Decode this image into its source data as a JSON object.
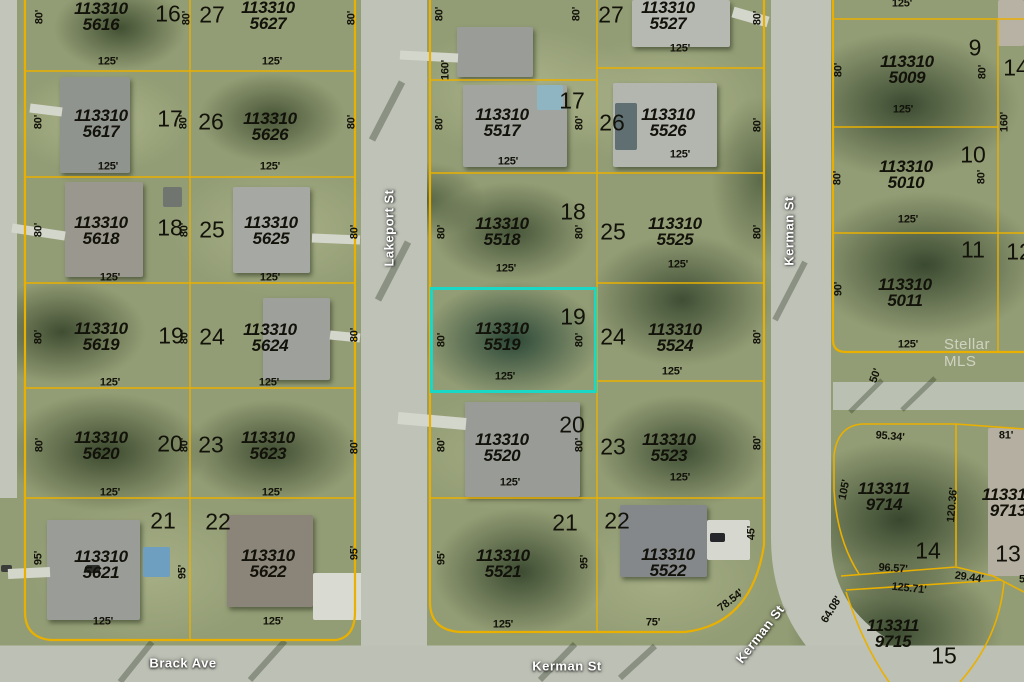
{
  "map": {
    "type": "aerial-parcel-map",
    "watermark": "Stellar MLS",
    "colors": {
      "parcel_line": "#EAB000",
      "highlight": "#1BD7C6",
      "road": "#BFC3B7"
    },
    "highlighted_parcel": {
      "apn": "113310 5519",
      "lot": "19"
    },
    "streets": [
      {
        "t": "Lakeport St",
        "x": 389,
        "y": 228,
        "r": -90
      },
      {
        "t": "Kerman St",
        "x": 789,
        "y": 231,
        "r": -90
      },
      {
        "t": "Brack Ave",
        "x": 183,
        "y": 663,
        "r": 0
      },
      {
        "t": "Kerman St",
        "x": 567,
        "y": 666,
        "r": 0
      },
      {
        "t": "Kerman St",
        "x": 760,
        "y": 634,
        "r": -52
      }
    ],
    "parcel_ids": [
      {
        "t": "113310\n5616",
        "x": 101,
        "y": 17
      },
      {
        "t": "113310\n5627",
        "x": 268,
        "y": 16
      },
      {
        "t": "113310\n5617",
        "x": 101,
        "y": 124
      },
      {
        "t": "113310\n5626",
        "x": 270,
        "y": 127
      },
      {
        "t": "113310\n5517",
        "x": 502,
        "y": 123
      },
      {
        "t": "113310\n5527",
        "x": 668,
        "y": 16
      },
      {
        "t": "113310\n5526",
        "x": 668,
        "y": 123
      },
      {
        "t": "113310\n5618",
        "x": 101,
        "y": 231
      },
      {
        "t": "113310\n5625",
        "x": 271,
        "y": 231
      },
      {
        "t": "113310\n5518",
        "x": 502,
        "y": 232
      },
      {
        "t": "113310\n5525",
        "x": 675,
        "y": 232
      },
      {
        "t": "113310\n5619",
        "x": 101,
        "y": 337
      },
      {
        "t": "113310\n5624",
        "x": 270,
        "y": 338
      },
      {
        "t": "113310\n5519",
        "x": 502,
        "y": 337
      },
      {
        "t": "113310\n5524",
        "x": 675,
        "y": 338
      },
      {
        "t": "113310\n5620",
        "x": 101,
        "y": 446
      },
      {
        "t": "113310\n5623",
        "x": 268,
        "y": 446
      },
      {
        "t": "113310\n5520",
        "x": 502,
        "y": 448
      },
      {
        "t": "113310\n5523",
        "x": 669,
        "y": 448
      },
      {
        "t": "113310\n5621",
        "x": 101,
        "y": 565
      },
      {
        "t": "113310\n5622",
        "x": 268,
        "y": 564
      },
      {
        "t": "113310\n5521",
        "x": 503,
        "y": 564
      },
      {
        "t": "113310\n5522",
        "x": 668,
        "y": 563
      },
      {
        "t": "113310\n5009",
        "x": 907,
        "y": 70
      },
      {
        "t": "113310\n5010",
        "x": 906,
        "y": 175
      },
      {
        "t": "113310\n5011",
        "x": 905,
        "y": 293
      },
      {
        "t": "113311\n9714",
        "x": 884,
        "y": 497
      },
      {
        "t": "113311\n9713",
        "x": 1008,
        "y": 503
      },
      {
        "t": "113311\n9715",
        "x": 893,
        "y": 634
      }
    ],
    "lot_numbers": [
      {
        "t": "16",
        "x": 168,
        "y": 14
      },
      {
        "t": "27",
        "x": 212,
        "y": 15
      },
      {
        "t": "17",
        "x": 170,
        "y": 119
      },
      {
        "t": "26",
        "x": 211,
        "y": 122
      },
      {
        "t": "18",
        "x": 170,
        "y": 228
      },
      {
        "t": "25",
        "x": 212,
        "y": 230
      },
      {
        "t": "19",
        "x": 171,
        "y": 336
      },
      {
        "t": "24",
        "x": 212,
        "y": 337
      },
      {
        "t": "20",
        "x": 170,
        "y": 444
      },
      {
        "t": "23",
        "x": 211,
        "y": 445
      },
      {
        "t": "21",
        "x": 163,
        "y": 521
      },
      {
        "t": "22",
        "x": 218,
        "y": 522
      },
      {
        "t": "27",
        "x": 611,
        "y": 15
      },
      {
        "t": "17",
        "x": 572,
        "y": 101
      },
      {
        "t": "26",
        "x": 612,
        "y": 123
      },
      {
        "t": "18",
        "x": 573,
        "y": 212
      },
      {
        "t": "25",
        "x": 613,
        "y": 232
      },
      {
        "t": "19",
        "x": 573,
        "y": 317
      },
      {
        "t": "24",
        "x": 613,
        "y": 337
      },
      {
        "t": "20",
        "x": 572,
        "y": 425
      },
      {
        "t": "23",
        "x": 613,
        "y": 447
      },
      {
        "t": "21",
        "x": 565,
        "y": 523
      },
      {
        "t": "22",
        "x": 617,
        "y": 521
      },
      {
        "t": "9",
        "x": 975,
        "y": 48
      },
      {
        "t": "14",
        "x": 1016,
        "y": 68
      },
      {
        "t": "10",
        "x": 973,
        "y": 155
      },
      {
        "t": "11",
        "x": 973,
        "y": 250
      },
      {
        "t": "12",
        "x": 1019,
        "y": 252
      },
      {
        "t": "14",
        "x": 928,
        "y": 551
      },
      {
        "t": "13",
        "x": 1008,
        "y": 554
      },
      {
        "t": "15",
        "x": 944,
        "y": 656
      }
    ],
    "dimensions": [
      {
        "t": "80'",
        "x": 40,
        "y": 17,
        "r": -90
      },
      {
        "t": "80'",
        "x": 187,
        "y": 18,
        "r": -90
      },
      {
        "t": "80'",
        "x": 352,
        "y": 18,
        "r": -90
      },
      {
        "t": "125'",
        "x": 108,
        "y": 62
      },
      {
        "t": "125'",
        "x": 272,
        "y": 62
      },
      {
        "t": "80'",
        "x": 39,
        "y": 122,
        "r": -90
      },
      {
        "t": "80'",
        "x": 184,
        "y": 122,
        "r": -90
      },
      {
        "t": "80'",
        "x": 352,
        "y": 122,
        "r": -90
      },
      {
        "t": "125'",
        "x": 108,
        "y": 167
      },
      {
        "t": "125'",
        "x": 270,
        "y": 167
      },
      {
        "t": "80'",
        "x": 39,
        "y": 230,
        "r": -90
      },
      {
        "t": "80'",
        "x": 185,
        "y": 230,
        "r": -90
      },
      {
        "t": "80'",
        "x": 355,
        "y": 232,
        "r": -90
      },
      {
        "t": "125'",
        "x": 110,
        "y": 278
      },
      {
        "t": "125'",
        "x": 270,
        "y": 278
      },
      {
        "t": "80'",
        "x": 39,
        "y": 337,
        "r": -90
      },
      {
        "t": "80'",
        "x": 185,
        "y": 337,
        "r": -90
      },
      {
        "t": "80'",
        "x": 355,
        "y": 335,
        "r": -90
      },
      {
        "t": "125'",
        "x": 110,
        "y": 383
      },
      {
        "t": "125'",
        "x": 269,
        "y": 383
      },
      {
        "t": "80'",
        "x": 40,
        "y": 445,
        "r": -90
      },
      {
        "t": "80'",
        "x": 185,
        "y": 445,
        "r": -90
      },
      {
        "t": "80'",
        "x": 355,
        "y": 447,
        "r": -90
      },
      {
        "t": "125'",
        "x": 110,
        "y": 493
      },
      {
        "t": "125'",
        "x": 272,
        "y": 493
      },
      {
        "t": "95'",
        "x": 39,
        "y": 558,
        "r": -90
      },
      {
        "t": "95'",
        "x": 183,
        "y": 572,
        "r": -90
      },
      {
        "t": "95'",
        "x": 355,
        "y": 553,
        "r": -90
      },
      {
        "t": "125'",
        "x": 103,
        "y": 622
      },
      {
        "t": "125'",
        "x": 273,
        "y": 622
      },
      {
        "t": "80'",
        "x": 440,
        "y": 14,
        "r": -90
      },
      {
        "t": "80'",
        "x": 577,
        "y": 14,
        "r": -90
      },
      {
        "t": "160'",
        "x": 446,
        "y": 70,
        "r": -90
      },
      {
        "t": "125'",
        "x": 680,
        "y": 49
      },
      {
        "t": "80'",
        "x": 758,
        "y": 18,
        "r": -90
      },
      {
        "t": "80'",
        "x": 440,
        "y": 123,
        "r": -90
      },
      {
        "t": "80'",
        "x": 580,
        "y": 123,
        "r": -90
      },
      {
        "t": "125'",
        "x": 508,
        "y": 162
      },
      {
        "t": "125'",
        "x": 680,
        "y": 155
      },
      {
        "t": "80'",
        "x": 758,
        "y": 125,
        "r": -90
      },
      {
        "t": "80'",
        "x": 442,
        "y": 232,
        "r": -90
      },
      {
        "t": "80'",
        "x": 580,
        "y": 232,
        "r": -90
      },
      {
        "t": "125'",
        "x": 506,
        "y": 269
      },
      {
        "t": "125'",
        "x": 678,
        "y": 265
      },
      {
        "t": "80'",
        "x": 758,
        "y": 232,
        "r": -90
      },
      {
        "t": "80'",
        "x": 442,
        "y": 340,
        "r": -90
      },
      {
        "t": "80'",
        "x": 580,
        "y": 340,
        "r": -90
      },
      {
        "t": "125'",
        "x": 505,
        "y": 377
      },
      {
        "t": "125'",
        "x": 672,
        "y": 372
      },
      {
        "t": "80'",
        "x": 758,
        "y": 337,
        "r": -90
      },
      {
        "t": "80'",
        "x": 442,
        "y": 445,
        "r": -90
      },
      {
        "t": "80'",
        "x": 580,
        "y": 445,
        "r": -90
      },
      {
        "t": "125'",
        "x": 510,
        "y": 483
      },
      {
        "t": "125'",
        "x": 680,
        "y": 478
      },
      {
        "t": "80'",
        "x": 758,
        "y": 443,
        "r": -90
      },
      {
        "t": "95'",
        "x": 442,
        "y": 558,
        "r": -90
      },
      {
        "t": "95'",
        "x": 585,
        "y": 562,
        "r": -90
      },
      {
        "t": "125'",
        "x": 503,
        "y": 625
      },
      {
        "t": "75'",
        "x": 653,
        "y": 623
      },
      {
        "t": "45'",
        "x": 752,
        "y": 533,
        "r": -90
      },
      {
        "t": "78.54'",
        "x": 731,
        "y": 601,
        "r": -38
      },
      {
        "t": "125'",
        "x": 902,
        "y": 4
      },
      {
        "t": "80'",
        "x": 839,
        "y": 70,
        "r": -90
      },
      {
        "t": "80'",
        "x": 983,
        "y": 72,
        "r": -90
      },
      {
        "t": "125'",
        "x": 903,
        "y": 110
      },
      {
        "t": "160'",
        "x": 1005,
        "y": 122,
        "r": -90
      },
      {
        "t": "80'",
        "x": 838,
        "y": 178,
        "r": -90
      },
      {
        "t": "80'",
        "x": 982,
        "y": 177,
        "r": -90
      },
      {
        "t": "125'",
        "x": 908,
        "y": 220
      },
      {
        "t": "90'",
        "x": 839,
        "y": 289,
        "r": -90
      },
      {
        "t": "125'",
        "x": 908,
        "y": 345
      },
      {
        "t": "50'",
        "x": 876,
        "y": 376,
        "r": -70
      },
      {
        "t": "95.34'",
        "x": 890,
        "y": 437,
        "r": 5
      },
      {
        "t": "81'",
        "x": 1006,
        "y": 436
      },
      {
        "t": "105'",
        "x": 845,
        "y": 490,
        "r": -78
      },
      {
        "t": "120.36'",
        "x": 953,
        "y": 505,
        "r": -85
      },
      {
        "t": "96.57'",
        "x": 893,
        "y": 569,
        "r": 4
      },
      {
        "t": "29.44'",
        "x": 969,
        "y": 578,
        "r": 8
      },
      {
        "t": "125.71'",
        "x": 909,
        "y": 589,
        "r": 6
      },
      {
        "t": "64.08'",
        "x": 832,
        "y": 610,
        "r": -58
      },
      {
        "t": "5",
        "x": 1022,
        "y": 580
      }
    ]
  }
}
